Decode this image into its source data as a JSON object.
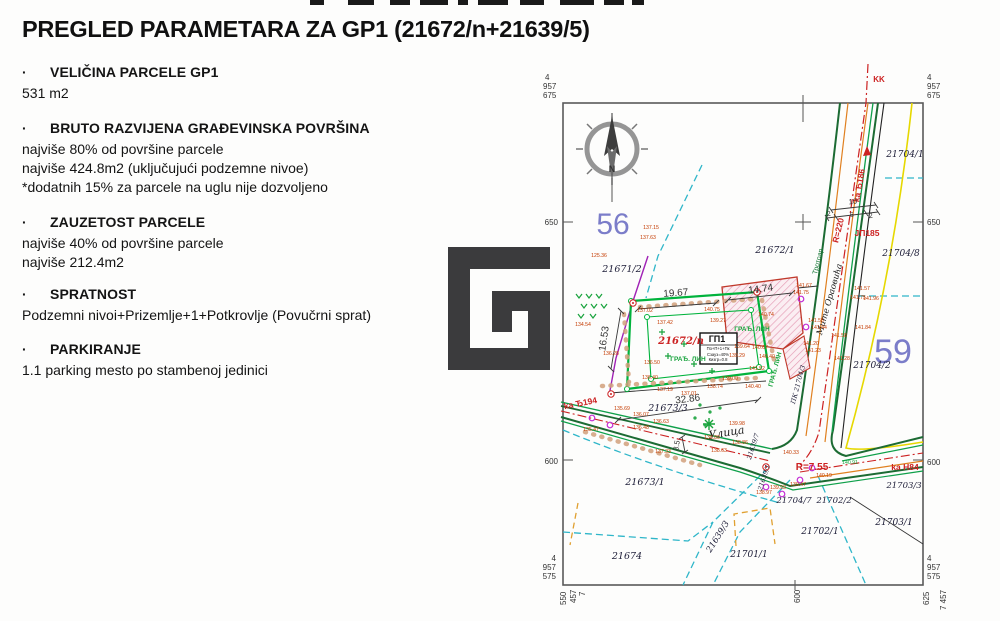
{
  "page": {
    "bullet": "·",
    "title": "PREGLED PARAMETARA ZA GP1 (21672/n+21639/5)"
  },
  "sections": [
    {
      "heading": "VELIČINA PARCELE GP1",
      "lines": [
        "531 m2"
      ]
    },
    {
      "heading": "BRUTO RAZVIJENA GRAĐEVINSKA POVRŠINA",
      "lines": [
        "najviše 80% od površine parcele",
        "najviše 424.8m2 (uključujući podzemne nivoe)",
        "*dodatnih 15% za parcele na uglu nije dozvoljeno"
      ]
    },
    {
      "heading": "ZAUZETOST PARCELE",
      "lines": [
        "najviše 40% od površine parcele",
        "najviše 212.4m2"
      ]
    },
    {
      "heading": "SPRATNOST",
      "lines": [
        "Podzemni nivoi+Prizemlje+1+Potkrovlje (Povučrni sprat)"
      ]
    },
    {
      "heading": "PARKIRANJE",
      "lines": [
        "1.1 parking mesto po stambenoj jedinici"
      ]
    }
  ],
  "colors": {
    "text": "#141414",
    "map_red": "#cc2222",
    "map_green_bright": "#00b33c",
    "map_green_dark": "#1c6b33",
    "map_cyan": "#2fb6c9",
    "map_purple": "#a021b5",
    "map_yellow": "#e6d800",
    "map_orange": "#e08020",
    "block_blue": "#7b7dc9",
    "spot_label": "#c43b00",
    "logo": "#3b3b3d"
  },
  "map": {
    "labels": [
      {
        "t": "4",
        "x": 545,
        "y": 80,
        "s": 8,
        "c": "#333",
        "a": "s",
        "n": "grid-coordinate-label"
      },
      {
        "t": "957",
        "x": 543,
        "y": 89,
        "s": 8,
        "c": "#333",
        "a": "s",
        "n": "grid-coordinate-label"
      },
      {
        "t": "675",
        "x": 543,
        "y": 98,
        "s": 8,
        "c": "#333",
        "a": "s",
        "n": "grid-coordinate-label"
      },
      {
        "t": "4",
        "x": 927,
        "y": 80,
        "s": 8,
        "c": "#333",
        "a": "s",
        "n": "grid-coordinate-label"
      },
      {
        "t": "957",
        "x": 927,
        "y": 89,
        "s": 8,
        "c": "#333",
        "a": "s",
        "n": "grid-coordinate-label"
      },
      {
        "t": "675",
        "x": 927,
        "y": 98,
        "s": 8,
        "c": "#333",
        "a": "s",
        "n": "grid-coordinate-label"
      },
      {
        "t": "650",
        "x": 558,
        "y": 225,
        "s": 8,
        "c": "#333",
        "a": "e",
        "n": "grid-coordinate-label"
      },
      {
        "t": "600",
        "x": 558,
        "y": 464,
        "s": 8,
        "c": "#333",
        "a": "e",
        "n": "grid-coordinate-label"
      },
      {
        "t": "650",
        "x": 927,
        "y": 225,
        "s": 8,
        "c": "#333",
        "a": "s",
        "n": "grid-coordinate-label"
      },
      {
        "t": "600",
        "x": 927,
        "y": 465,
        "s": 8,
        "c": "#333",
        "a": "s",
        "n": "grid-coordinate-label"
      },
      {
        "t": "4",
        "x": 556,
        "y": 561,
        "s": 8,
        "c": "#333",
        "a": "e",
        "n": "grid-coordinate-label"
      },
      {
        "t": "957",
        "x": 556,
        "y": 570,
        "s": 8,
        "c": "#333",
        "a": "e",
        "n": "grid-coordinate-label"
      },
      {
        "t": "575",
        "x": 556,
        "y": 579,
        "s": 8,
        "c": "#333",
        "a": "e",
        "n": "grid-coordinate-label"
      },
      {
        "t": "4",
        "x": 927,
        "y": 561,
        "s": 8,
        "c": "#333",
        "a": "s",
        "n": "grid-coordinate-label"
      },
      {
        "t": "957",
        "x": 927,
        "y": 570,
        "s": 8,
        "c": "#333",
        "a": "s",
        "n": "grid-coordinate-label"
      },
      {
        "t": "575",
        "x": 927,
        "y": 579,
        "s": 8,
        "c": "#333",
        "a": "s",
        "n": "grid-coordinate-label"
      },
      {
        "t": "550",
        "x": 566,
        "y": 605,
        "s": 8,
        "c": "#333",
        "r": -90,
        "a": "s",
        "n": "grid-coordinate-label"
      },
      {
        "t": "457",
        "x": 576,
        "y": 603,
        "s": 8,
        "c": "#333",
        "r": -90,
        "a": "s",
        "n": "grid-coordinate-label"
      },
      {
        "t": "7",
        "x": 585,
        "y": 596,
        "s": 8,
        "c": "#333",
        "r": -90,
        "a": "s",
        "n": "grid-coordinate-label"
      },
      {
        "t": "600",
        "x": 800,
        "y": 603,
        "s": 8,
        "c": "#333",
        "r": -90,
        "a": "s",
        "n": "grid-coordinate-label"
      },
      {
        "t": "625",
        "x": 929,
        "y": 605,
        "s": 8,
        "c": "#333",
        "r": -90,
        "a": "s",
        "n": "grid-coordinate-label"
      },
      {
        "t": "7 457",
        "x": 946,
        "y": 610,
        "s": 8,
        "c": "#333",
        "r": -90,
        "a": "s",
        "n": "grid-coordinate-label"
      },
      {
        "t": "KK",
        "x": 879,
        "y": 82,
        "s": 8,
        "c": "#cc2222",
        "b": 1,
        "n": "route-label"
      },
      {
        "t": "N",
        "x": 612,
        "y": 172,
        "s": 9,
        "c": "#333",
        "b": 1,
        "n": "compass-n-label"
      },
      {
        "t": "56",
        "x": 613,
        "y": 234,
        "s": 30,
        "c": "#7b7dc9",
        "n": "block-number"
      },
      {
        "t": "59",
        "x": 893,
        "y": 363,
        "s": 34,
        "c": "#7b7dc9",
        "n": "block-number"
      },
      {
        "t": "21671/2",
        "x": 622,
        "y": 272,
        "s": 9.5,
        "c": "#20203a",
        "i": 1,
        "f": "ser",
        "n": "parcel-label"
      },
      {
        "t": "21672/1",
        "x": 775,
        "y": 253,
        "s": 9.5,
        "c": "#20203a",
        "i": 1,
        "f": "ser",
        "n": "parcel-label"
      },
      {
        "t": "21704/1",
        "x": 905,
        "y": 157,
        "s": 9,
        "c": "#20203a",
        "i": 1,
        "f": "ser",
        "n": "parcel-label"
      },
      {
        "t": "21704/8",
        "x": 901,
        "y": 256,
        "s": 9,
        "c": "#20203a",
        "i": 1,
        "f": "ser",
        "n": "parcel-label"
      },
      {
        "t": "21704/2",
        "x": 872,
        "y": 368,
        "s": 9,
        "c": "#20203a",
        "i": 1,
        "f": "ser",
        "n": "parcel-label"
      },
      {
        "t": "21673/3",
        "x": 668,
        "y": 411,
        "s": 9.5,
        "c": "#20203a",
        "i": 1,
        "f": "ser",
        "n": "parcel-label"
      },
      {
        "t": "21673/1",
        "x": 645,
        "y": 485,
        "s": 9.5,
        "c": "#20203a",
        "i": 1,
        "f": "ser",
        "n": "parcel-label"
      },
      {
        "t": "21674",
        "x": 627,
        "y": 559,
        "s": 9.5,
        "c": "#20203a",
        "i": 1,
        "f": "ser",
        "n": "parcel-label"
      },
      {
        "t": "21701/1",
        "x": 749,
        "y": 557,
        "s": 9,
        "c": "#20203a",
        "i": 1,
        "f": "ser",
        "n": "parcel-label"
      },
      {
        "t": "21702/1",
        "x": 820,
        "y": 534,
        "s": 9,
        "c": "#20203a",
        "i": 1,
        "f": "ser",
        "n": "parcel-label"
      },
      {
        "t": "21702/2",
        "x": 834,
        "y": 503,
        "s": 8.5,
        "c": "#20203a",
        "i": 1,
        "f": "ser",
        "n": "parcel-label"
      },
      {
        "t": "21704/7",
        "x": 794,
        "y": 503,
        "s": 8.5,
        "c": "#20203a",
        "i": 1,
        "f": "ser",
        "n": "parcel-label"
      },
      {
        "t": "21703/1",
        "x": 894,
        "y": 525,
        "s": 9,
        "c": "#20203a",
        "i": 1,
        "f": "ser",
        "n": "parcel-label"
      },
      {
        "t": "21703/3",
        "x": 904,
        "y": 488,
        "s": 8.5,
        "c": "#20203a",
        "i": 1,
        "f": "ser",
        "n": "parcel-label"
      },
      {
        "t": "21639/3",
        "x": 720,
        "y": 538,
        "s": 8.5,
        "c": "#20203a",
        "i": 1,
        "f": "ser",
        "r": -58,
        "n": "parcel-label"
      },
      {
        "t": "21639/7",
        "x": 755,
        "y": 447,
        "s": 6.5,
        "c": "#20203a",
        "i": 1,
        "f": "ser",
        "r": -72,
        "n": "parcel-label"
      },
      {
        "t": "21639/1",
        "x": 766,
        "y": 478,
        "s": 6.5,
        "c": "#20203a",
        "i": 1,
        "f": "ser",
        "r": -72,
        "n": "parcel-label"
      },
      {
        "t": "ПК 21704/3",
        "x": 800,
        "y": 385,
        "s": 6.5,
        "c": "#20203a",
        "i": 1,
        "f": "ser",
        "r": -75,
        "n": "parcel-label"
      },
      {
        "t": "21672/n",
        "x": 681,
        "y": 344,
        "s": 10,
        "c": "#cc2222",
        "i": 1,
        "b": 1,
        "f": "ser",
        "n": "gp1-parcel-label"
      },
      {
        "t": "Улица",
        "x": 727,
        "y": 436,
        "s": 11,
        "c": "#222",
        "i": 1,
        "f": "ser",
        "r": -9,
        "n": "street-label"
      },
      {
        "t": "Мите Ораовића",
        "x": 832,
        "y": 300,
        "s": 8.5,
        "c": "#222",
        "i": 1,
        "f": "ser",
        "r": -74,
        "n": "street-name-label"
      },
      {
        "t": "Тротоар",
        "x": 820,
        "y": 262,
        "s": 7,
        "c": "#1a7a3a",
        "r": -76,
        "n": "sidewalk-label"
      },
      {
        "t": "ka Ђ186",
        "x": 862,
        "y": 186,
        "s": 8.5,
        "c": "#cc2222",
        "b": 1,
        "r": -80,
        "n": "route-direction-label"
      },
      {
        "t": "ka Ђ194",
        "x": 581,
        "y": 406,
        "s": 8.5,
        "c": "#cc2222",
        "b": 1,
        "r": -11,
        "n": "route-direction-label"
      },
      {
        "t": "ka Н84",
        "x": 905,
        "y": 470,
        "s": 8.5,
        "c": "#cc2222",
        "b": 1,
        "n": "route-direction-label"
      },
      {
        "t": "R=220",
        "x": 841,
        "y": 231,
        "s": 8.5,
        "c": "#cc2222",
        "b": 1,
        "r": -76,
        "n": "radius-label"
      },
      {
        "t": "R=7.55",
        "x": 812,
        "y": 470,
        "s": 10,
        "c": "#cc2222",
        "b": 1,
        "n": "radius-label"
      },
      {
        "t": "ЈП185",
        "x": 867,
        "y": 236,
        "s": 8.5,
        "c": "#cc2222",
        "b": 1,
        "n": "point-label"
      },
      {
        "t": "ГП1",
        "x": 717,
        "y": 342,
        "s": 9,
        "c": "#111",
        "b": 1,
        "n": "gp1-box-title"
      },
      {
        "t": "По+П+1+Пк",
        "x": 718,
        "y": 350,
        "s": 4.2,
        "c": "#111",
        "n": "gp1-box-line"
      },
      {
        "t": "Сзауз=40%",
        "x": 718,
        "y": 356,
        "s": 4.2,
        "c": "#111",
        "n": "gp1-box-line"
      },
      {
        "t": "Кизгр=0.8",
        "x": 718,
        "y": 361,
        "s": 4.2,
        "c": "#111",
        "n": "gp1-box-line"
      },
      {
        "t": "ГРАЂ. ЛИН",
        "x": 752,
        "y": 331,
        "s": 6.5,
        "c": "#18a33c",
        "b": 1,
        "n": "building-line-label"
      },
      {
        "t": "ГРАЂ. ЛИН",
        "x": 688,
        "y": 361,
        "s": 6.5,
        "c": "#18a33c",
        "b": 1,
        "n": "building-line-label"
      },
      {
        "t": "ГРАЂ. ЛИН",
        "x": 777,
        "y": 370,
        "s": 6.5,
        "c": "#18a33c",
        "b": 1,
        "r": -75,
        "n": "building-line-label"
      },
      {
        "t": "19.67",
        "x": 676,
        "y": 296,
        "s": 10,
        "c": "#333",
        "r": -4,
        "n": "dimension-label"
      },
      {
        "t": "14.74",
        "x": 761,
        "y": 292,
        "s": 10,
        "c": "#333",
        "r": -7,
        "n": "dimension-label"
      },
      {
        "t": "16.53",
        "x": 607,
        "y": 339,
        "s": 10,
        "c": "#333",
        "r": -82,
        "n": "dimension-label"
      },
      {
        "t": "32.86",
        "x": 688,
        "y": 402,
        "s": 10,
        "c": "#333",
        "r": -7,
        "n": "dimension-label"
      },
      {
        "t": "10",
        "x": 853,
        "y": 204,
        "s": 7.5,
        "c": "#333",
        "r": -5,
        "n": "dimension-label"
      },
      {
        "t": "2",
        "x": 829,
        "y": 216,
        "s": 7,
        "c": "#333",
        "r": -5,
        "n": "dimension-label"
      },
      {
        "t": "6",
        "x": 852,
        "y": 217,
        "s": 7,
        "c": "#333",
        "r": -5,
        "n": "dimension-label"
      },
      {
        "t": "2",
        "x": 871,
        "y": 218,
        "s": 7,
        "c": "#333",
        "r": -5,
        "n": "dimension-label"
      },
      {
        "t": "3.5",
        "x": 679,
        "y": 446,
        "s": 7.5,
        "c": "#333",
        "r": -80,
        "n": "dimension-label"
      },
      {
        "t": "137.15",
        "x": 651,
        "y": 229,
        "n": "spot-elevation"
      },
      {
        "t": "137.63",
        "x": 648,
        "y": 239,
        "n": "spot-elevation"
      },
      {
        "t": "125.36",
        "x": 599,
        "y": 257,
        "n": "spot-elevation"
      },
      {
        "t": "134.54",
        "x": 583,
        "y": 326,
        "n": "spot-elevation"
      },
      {
        "t": "137.02",
        "x": 645,
        "y": 312,
        "n": "spot-elevation"
      },
      {
        "t": "137.42",
        "x": 665,
        "y": 324,
        "n": "spot-elevation"
      },
      {
        "t": "140.75",
        "x": 712,
        "y": 311,
        "n": "spot-elevation"
      },
      {
        "t": "139.27",
        "x": 718,
        "y": 322,
        "n": "spot-elevation"
      },
      {
        "t": "140.74",
        "x": 766,
        "y": 316,
        "n": "spot-elevation"
      },
      {
        "t": "136.28",
        "x": 611,
        "y": 355,
        "n": "spot-elevation"
      },
      {
        "t": "136.50",
        "x": 652,
        "y": 364,
        "n": "spot-elevation"
      },
      {
        "t": "136.40",
        "x": 650,
        "y": 379,
        "n": "spot-elevation"
      },
      {
        "t": "139.64",
        "x": 742,
        "y": 348,
        "n": "spot-elevation"
      },
      {
        "t": "140.67",
        "x": 760,
        "y": 349,
        "n": "spot-elevation"
      },
      {
        "t": "139.29",
        "x": 737,
        "y": 357,
        "n": "spot-elevation"
      },
      {
        "t": "140.40",
        "x": 767,
        "y": 358,
        "n": "spot-elevation"
      },
      {
        "t": "141.52",
        "x": 757,
        "y": 370,
        "n": "spot-elevation"
      },
      {
        "t": "139.00",
        "x": 730,
        "y": 380,
        "n": "spot-elevation"
      },
      {
        "t": "138.74",
        "x": 715,
        "y": 388,
        "n": "spot-elevation"
      },
      {
        "t": "140.40",
        "x": 753,
        "y": 388,
        "n": "spot-elevation"
      },
      {
        "t": "137.19",
        "x": 665,
        "y": 391,
        "n": "spot-elevation"
      },
      {
        "t": "137.01",
        "x": 689,
        "y": 395,
        "n": "spot-elevation"
      },
      {
        "t": "135.69",
        "x": 622,
        "y": 410,
        "n": "spot-elevation"
      },
      {
        "t": "136.07",
        "x": 641,
        "y": 416,
        "n": "spot-elevation"
      },
      {
        "t": "136.63",
        "x": 661,
        "y": 423,
        "n": "spot-elevation"
      },
      {
        "t": "136.48",
        "x": 641,
        "y": 429,
        "n": "spot-elevation"
      },
      {
        "t": "135.47",
        "x": 591,
        "y": 431,
        "n": "spot-elevation"
      },
      {
        "t": "137.33",
        "x": 663,
        "y": 453,
        "n": "spot-elevation"
      },
      {
        "t": "139.98",
        "x": 737,
        "y": 425,
        "n": "spot-elevation"
      },
      {
        "t": "138.89",
        "x": 712,
        "y": 439,
        "n": "spot-elevation"
      },
      {
        "t": "138.86",
        "x": 740,
        "y": 444,
        "n": "spot-elevation"
      },
      {
        "t": "138.63",
        "x": 719,
        "y": 452,
        "n": "spot-elevation"
      },
      {
        "t": "141.67",
        "x": 804,
        "y": 287,
        "n": "spot-elevation"
      },
      {
        "t": "141.75",
        "x": 801,
        "y": 294,
        "n": "spot-elevation"
      },
      {
        "t": "141.57",
        "x": 862,
        "y": 290,
        "n": "spot-elevation"
      },
      {
        "t": "141.75",
        "x": 858,
        "y": 299,
        "n": "spot-elevation"
      },
      {
        "t": "141.96",
        "x": 871,
        "y": 300,
        "n": "spot-elevation"
      },
      {
        "t": "141.84",
        "x": 863,
        "y": 329,
        "n": "spot-elevation"
      },
      {
        "t": "141.58",
        "x": 839,
        "y": 337,
        "n": "spot-elevation"
      },
      {
        "t": "141.44",
        "x": 819,
        "y": 329,
        "n": "spot-elevation"
      },
      {
        "t": "141.55",
        "x": 816,
        "y": 322,
        "n": "spot-elevation"
      },
      {
        "t": "141.20",
        "x": 811,
        "y": 345,
        "n": "spot-elevation"
      },
      {
        "t": "141.23",
        "x": 813,
        "y": 352,
        "n": "spot-elevation"
      },
      {
        "t": "141.28",
        "x": 842,
        "y": 360,
        "n": "spot-elevation"
      },
      {
        "t": "140.33",
        "x": 791,
        "y": 454,
        "n": "spot-elevation"
      },
      {
        "t": "140.91",
        "x": 850,
        "y": 464,
        "c": "#18a33c",
        "n": "spot-elevation"
      },
      {
        "t": "139.93",
        "x": 778,
        "y": 489,
        "n": "spot-elevation"
      },
      {
        "t": "138.97",
        "x": 764,
        "y": 494,
        "n": "spot-elevation"
      },
      {
        "t": "140.19",
        "x": 824,
        "y": 477,
        "n": "spot-elevation"
      },
      {
        "t": "139.47",
        "x": 798,
        "y": 486,
        "n": "spot-elevation"
      }
    ]
  }
}
